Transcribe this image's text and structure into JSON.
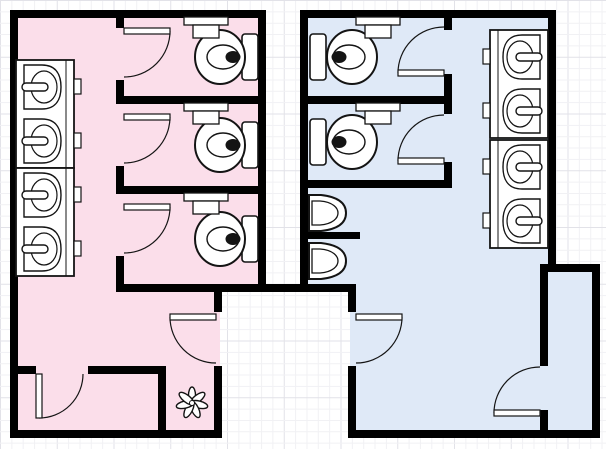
{
  "canvas": {
    "width": 606,
    "height": 449
  },
  "colors": {
    "background": "#ffffff",
    "grid_minor": "#f1f1f4",
    "grid_major": "#e2e2e8",
    "wall": "#000000",
    "womens_room_fill": "#fbdeea",
    "mens_room_fill": "#dfe9f7",
    "fixture_fill": "#ffffff",
    "fixture_stroke": "#141414"
  },
  "grid": {
    "minor_step": 11.35,
    "major_every": 5
  },
  "floor_plan": {
    "fills": [
      {
        "name": "womens-restroom-upper",
        "room": "womens",
        "x": 12,
        "y": 12,
        "w": 252,
        "h": 278
      },
      {
        "name": "womens-restroom-lower",
        "room": "womens",
        "x": 12,
        "y": 288,
        "w": 208,
        "h": 148
      },
      {
        "name": "mens-restroom-upper",
        "room": "mens",
        "x": 302,
        "y": 12,
        "w": 252,
        "h": 278
      },
      {
        "name": "mens-restroom-lower",
        "room": "mens",
        "x": 350,
        "y": 288,
        "w": 200,
        "h": 146
      },
      {
        "name": "mens-storage-closet",
        "room": "mens",
        "x": 546,
        "y": 270,
        "w": 48,
        "h": 162
      }
    ],
    "walls": [
      {
        "x": 10,
        "y": 10,
        "w": 256,
        "h": 8
      },
      {
        "x": 10,
        "y": 10,
        "w": 8,
        "h": 428
      },
      {
        "x": 10,
        "y": 430,
        "w": 212,
        "h": 8
      },
      {
        "x": 258,
        "y": 10,
        "w": 8,
        "h": 282
      },
      {
        "x": 116,
        "y": 284,
        "w": 240,
        "h": 8
      },
      {
        "x": 116,
        "y": 18,
        "w": 8,
        "h": 10
      },
      {
        "x": 116,
        "y": 80,
        "w": 8,
        "h": 24
      },
      {
        "x": 116,
        "y": 166,
        "w": 8,
        "h": 28
      },
      {
        "x": 116,
        "y": 256,
        "w": 8,
        "h": 36
      },
      {
        "x": 116,
        "y": 96,
        "w": 142,
        "h": 8
      },
      {
        "x": 116,
        "y": 186,
        "w": 142,
        "h": 8
      },
      {
        "x": 18,
        "y": 366,
        "w": 18,
        "h": 8
      },
      {
        "x": 88,
        "y": 366,
        "w": 78,
        "h": 8
      },
      {
        "x": 158,
        "y": 374,
        "w": 8,
        "h": 56
      },
      {
        "x": 214,
        "y": 292,
        "w": 8,
        "h": 20
      },
      {
        "x": 214,
        "y": 366,
        "w": 8,
        "h": 64
      },
      {
        "x": 300,
        "y": 10,
        "w": 256,
        "h": 8
      },
      {
        "x": 300,
        "y": 10,
        "w": 8,
        "h": 282
      },
      {
        "x": 348,
        "y": 292,
        "w": 8,
        "h": 20
      },
      {
        "x": 348,
        "y": 366,
        "w": 8,
        "h": 64
      },
      {
        "x": 348,
        "y": 430,
        "w": 252,
        "h": 8
      },
      {
        "x": 548,
        "y": 10,
        "w": 8,
        "h": 262
      },
      {
        "x": 540,
        "y": 264,
        "w": 60,
        "h": 8
      },
      {
        "x": 592,
        "y": 272,
        "w": 8,
        "h": 158
      },
      {
        "x": 540,
        "y": 272,
        "w": 8,
        "h": 94
      },
      {
        "x": 540,
        "y": 410,
        "w": 8,
        "h": 20
      },
      {
        "x": 308,
        "y": 96,
        "w": 144,
        "h": 8
      },
      {
        "x": 308,
        "y": 180,
        "w": 144,
        "h": 8
      },
      {
        "x": 444,
        "y": 18,
        "w": 8,
        "h": 12
      },
      {
        "x": 444,
        "y": 74,
        "w": 8,
        "h": 22
      },
      {
        "x": 444,
        "y": 104,
        "w": 8,
        "h": 10
      },
      {
        "x": 444,
        "y": 162,
        "w": 8,
        "h": 18
      },
      {
        "x": 308,
        "y": 232,
        "w": 52,
        "h": 7
      }
    ],
    "doors": [
      {
        "name": "womens-stall-door-1",
        "leaf": [
          124,
          28,
          46,
          6
        ],
        "arc": "M 170 31 A 46 46 0 0 1 124 77"
      },
      {
        "name": "womens-stall-door-2",
        "leaf": [
          124,
          114,
          46,
          6
        ],
        "arc": "M 170 117 A 46 46 0 0 1 124 163"
      },
      {
        "name": "womens-stall-door-3",
        "leaf": [
          124,
          204,
          46,
          6
        ],
        "arc": "M 170 207 A 46 46 0 0 1 124 253"
      },
      {
        "name": "womens-entrance-door",
        "leaf": [
          170,
          314,
          46,
          6
        ],
        "arc": "M 170 317 A 46 46 0 0 0 216 363"
      },
      {
        "name": "womens-closet-door",
        "leaf": [
          36,
          374,
          6,
          44
        ],
        "arc": "M 39 418 A 44 44 0 0 0 83 374"
      },
      {
        "name": "mens-stall-door-1",
        "leaf": [
          398,
          70,
          46,
          6
        ],
        "arc": "M 398 73 A 46 46 0 0 1 444 27"
      },
      {
        "name": "mens-stall-door-2",
        "leaf": [
          398,
          158,
          46,
          6
        ],
        "arc": "M 398 161 A 46 46 0 0 1 444 115"
      },
      {
        "name": "mens-entrance-door",
        "leaf": [
          356,
          314,
          46,
          6
        ],
        "arc": "M 402 317 A 46 46 0 0 1 356 363"
      },
      {
        "name": "mens-storage-door",
        "leaf": [
          494,
          410,
          46,
          6
        ],
        "arc": "M 494 413 A 46 46 0 0 1 540 367"
      }
    ],
    "toilets": [
      {
        "room": "womens",
        "tank_x": 242,
        "bowl_cx": 220,
        "cy": 57
      },
      {
        "room": "womens",
        "tank_x": 242,
        "bowl_cx": 220,
        "cy": 145
      },
      {
        "room": "womens",
        "tank_x": 242,
        "bowl_cx": 220,
        "cy": 239
      },
      {
        "room": "mens",
        "tank_x": 310,
        "bowl_cx": 352,
        "cy": 57
      },
      {
        "room": "mens",
        "tank_x": 310,
        "bowl_cx": 352,
        "cy": 142
      }
    ],
    "sink_counters": [
      {
        "x": 16,
        "y": 60,
        "w": 58,
        "h": 108,
        "edge_x": 66
      },
      {
        "x": 16,
        "y": 168,
        "w": 58,
        "h": 108,
        "edge_x": 66
      },
      {
        "x": 490,
        "y": 30,
        "w": 58,
        "h": 108,
        "edge_x": 498
      },
      {
        "x": 490,
        "y": 140,
        "w": 58,
        "h": 108,
        "edge_x": 498
      }
    ],
    "sinks": [
      {
        "side": "left",
        "cy": 87
      },
      {
        "side": "left",
        "cy": 141
      },
      {
        "side": "left",
        "cy": 195
      },
      {
        "side": "left",
        "cy": 249
      },
      {
        "side": "right",
        "cy": 57
      },
      {
        "side": "right",
        "cy": 111
      },
      {
        "side": "right",
        "cy": 167
      },
      {
        "side": "right",
        "cy": 221
      }
    ],
    "urinals": [
      {
        "cy": 213
      },
      {
        "cy": 261
      }
    ],
    "paper_dispensers": [
      {
        "x": 184,
        "y": 17
      },
      {
        "x": 184,
        "y": 103
      },
      {
        "x": 184,
        "y": 193
      },
      {
        "x": 356,
        "y": 17
      },
      {
        "x": 356,
        "y": 103
      }
    ],
    "plant": {
      "cx": 192,
      "cy": 403,
      "petals": 7,
      "offset": 7,
      "petal_rx": 9,
      "petal_ry": 3.6
    }
  }
}
